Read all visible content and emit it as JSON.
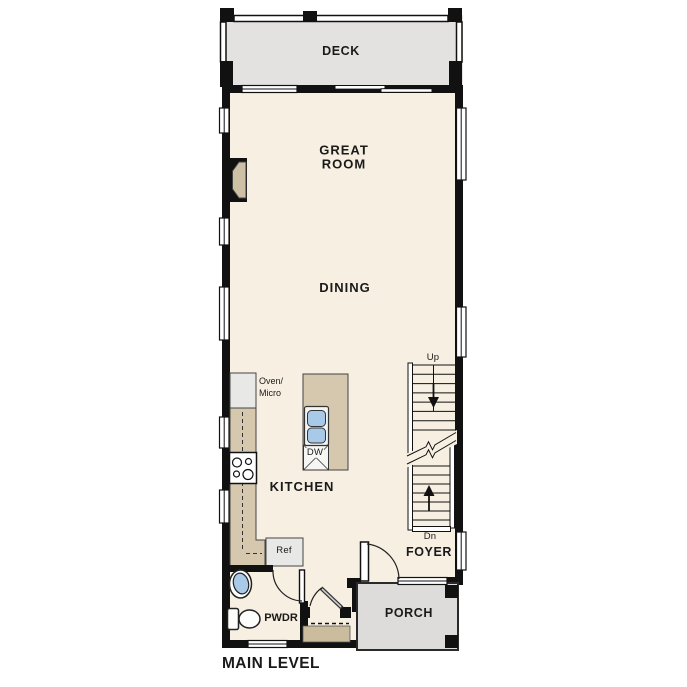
{
  "page": {
    "title": "MAIN LEVEL",
    "background": "#ffffff"
  },
  "floor_plan": {
    "level_label": "MAIN LEVEL",
    "rooms": {
      "deck": {
        "label": "DECK"
      },
      "great_room": {
        "line1": "GREAT",
        "line2": "ROOM"
      },
      "dining": {
        "label": "DINING"
      },
      "kitchen": {
        "label": "KITCHEN"
      },
      "foyer": {
        "label": "FOYER"
      },
      "porch": {
        "label": "PORCH"
      },
      "powder": {
        "label": "PWDR"
      }
    },
    "annotations": {
      "stairs_up": "Up",
      "stairs_down": "Dn",
      "oven_micro_line1": "Oven/",
      "oven_micro_line2": "Micro",
      "dishwasher": "DW",
      "refrigerator": "Ref"
    },
    "colors": {
      "wall": "#111111",
      "interior_floor": "#f7efe2",
      "deck_floor": "#e3e2e0",
      "porch_floor": "#dddcda",
      "counter_tan": "#d5c8ae",
      "entry_step_tan": "#cbbc9e",
      "fireplace_tan": "#cec0a5",
      "appliance_gray": "#e8e8e6",
      "fixture_blue": "#a9c9e8"
    }
  }
}
